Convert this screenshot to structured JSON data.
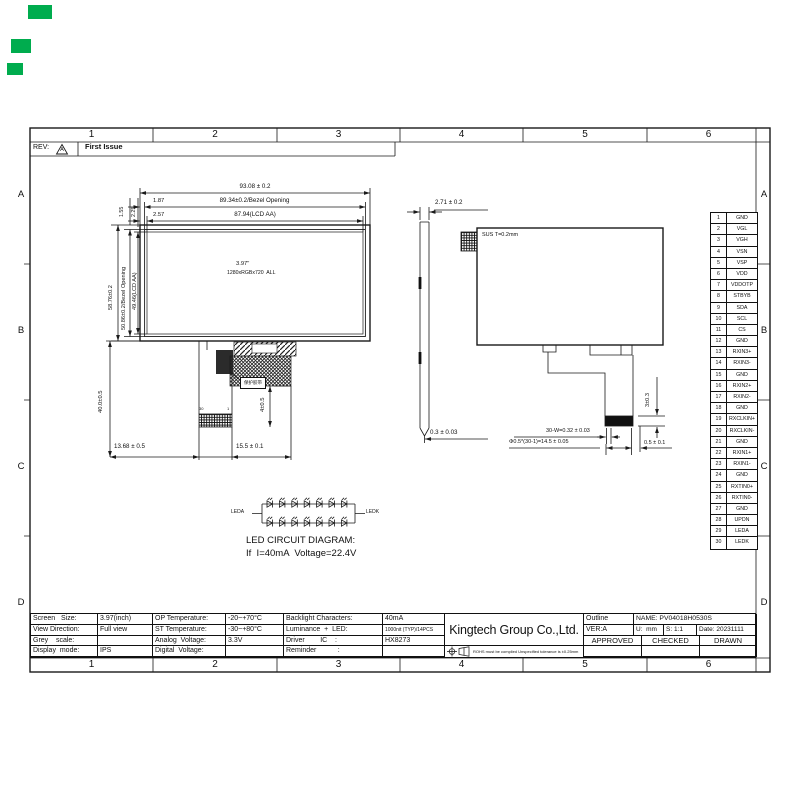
{
  "sheet": {
    "background": "#ffffff",
    "line_color": "#1a1a1a"
  },
  "annotations": {
    "green_marks_color": "#00AC4E"
  },
  "revision": {
    "label": "REV:",
    "triangle_letter": "A",
    "note": "First Issue"
  },
  "frame": {
    "columns": [
      "1",
      "2",
      "3",
      "4",
      "5",
      "6"
    ],
    "rows": [
      "A",
      "B",
      "C",
      "D"
    ]
  },
  "front_view": {
    "dim_width_outline": "93.08 ± 0.2",
    "dim_width_bezel": "89.34±0.2/Bezel Opening",
    "dim_width_aa": "87.94(LCD AA)",
    "dim_bezel_left": "1.87",
    "dim_aa_left": "2.57",
    "dim_bezel_top": "1.55",
    "dim_aa_top": "2.25",
    "dim_height_outline": "58.76±0.2",
    "dim_height_bezel": "50.86±0.2/Bezel Opening",
    "dim_height_aa": "49.46(LCD AA)",
    "size_label": "3.97\"",
    "resolution_label": "1280xRGBx720  ALL",
    "dim_fpc_length": "40.0±0.5",
    "dim_fpc_tail": "4±0.5",
    "dim_fpc_left": "13.68 ± 0.5",
    "dim_fpc_right": "15.5 ± 0.1",
    "tape_callout": "保护胶带",
    "connector_pin_30": "30",
    "connector_pin_1": "1"
  },
  "side_view": {
    "dim_thickness": "2.71 ± 0.2",
    "dim_tape": "0.3 ± 0.03"
  },
  "rear_view": {
    "sus_label": "SUS T=0.2mm",
    "dim_connector_height": "3±0.3",
    "dim_pin_width": "30-W=0.32 ± 0.03",
    "dim_pin_pitch": "Φ0.5*(30-1)=14.5 ± 0.05",
    "dim_edge": "0.5 ± 0.1"
  },
  "pin_table": {
    "pins": [
      {
        "no": "1",
        "name": "GND"
      },
      {
        "no": "2",
        "name": "VGL"
      },
      {
        "no": "3",
        "name": "VGH"
      },
      {
        "no": "4",
        "name": "VSN"
      },
      {
        "no": "5",
        "name": "VSP"
      },
      {
        "no": "6",
        "name": "VDD"
      },
      {
        "no": "7",
        "name": "VDDOTP"
      },
      {
        "no": "8",
        "name": "STBYB"
      },
      {
        "no": "9",
        "name": "SDA"
      },
      {
        "no": "10",
        "name": "SCL"
      },
      {
        "no": "11",
        "name": "CS"
      },
      {
        "no": "12",
        "name": "GND"
      },
      {
        "no": "13",
        "name": "RXIN3+"
      },
      {
        "no": "14",
        "name": "RXIN3-"
      },
      {
        "no": "15",
        "name": "GND"
      },
      {
        "no": "16",
        "name": "RXIN2+"
      },
      {
        "no": "17",
        "name": "RXIN2-"
      },
      {
        "no": "18",
        "name": "GND"
      },
      {
        "no": "19",
        "name": "RXCLKIN+"
      },
      {
        "no": "20",
        "name": "RXCLKIN-"
      },
      {
        "no": "21",
        "name": "GND"
      },
      {
        "no": "22",
        "name": "RXIN1+"
      },
      {
        "no": "23",
        "name": "RXIN1-"
      },
      {
        "no": "24",
        "name": "GND"
      },
      {
        "no": "25",
        "name": "RXTIN0+"
      },
      {
        "no": "26",
        "name": "RXTIN0-"
      },
      {
        "no": "27",
        "name": "GND"
      },
      {
        "no": "28",
        "name": "UPDN"
      },
      {
        "no": "29",
        "name": "LEDA"
      },
      {
        "no": "30",
        "name": "LEDK"
      }
    ]
  },
  "led_diagram": {
    "anode_label": "LEDA",
    "cathode_label": "LEDK",
    "rows": 2,
    "leds_per_row": 7,
    "title": "LED CIRCUIT DIAGRAM:",
    "condition": "If  I=40mA  Voltage=22.4V"
  },
  "title_block": {
    "spec_pairs_1": [
      {
        "label": "Screen   Size:",
        "value": "3.97(inch)"
      },
      {
        "label": "View Direction:",
        "value": "Full view"
      },
      {
        "label": "Grey    scale:",
        "value": ""
      },
      {
        "label": "Display  mode:",
        "value": "IPS"
      }
    ],
    "spec_pairs_2": [
      {
        "label": "OP Temperature:",
        "value": "-20~+70°C"
      },
      {
        "label": "ST Temperature:",
        "value": "-30~+80°C"
      },
      {
        "label": "Analog  Voltage:",
        "value": "3.3V"
      },
      {
        "label": "Digital  Voltage:",
        "value": ""
      }
    ],
    "spec_pairs_3": [
      {
        "label": "Backlight Characters:",
        "value": "40mA"
      },
      {
        "label": "Luminance  +  LED:",
        "value": "1000nit (TYP)/14PCS"
      },
      {
        "label": "Driver        IC    :",
        "value": "HX8273"
      },
      {
        "label": "Reminder           :",
        "value": ""
      }
    ],
    "company": "Kingtech Group Co.,Ltd.",
    "rohs_note": "ROHS must be complied Unspecified tolerance is ±0.25mm",
    "outline_label": "Outline",
    "name": "NAME: PV04018H0530S",
    "version": "VER:A",
    "unit": "U:  mm",
    "scale": "S: 1:1",
    "date": "Date: 20231111",
    "approved": "APPROVED",
    "checked": "CHECKED",
    "drawn": "DRAWN"
  }
}
